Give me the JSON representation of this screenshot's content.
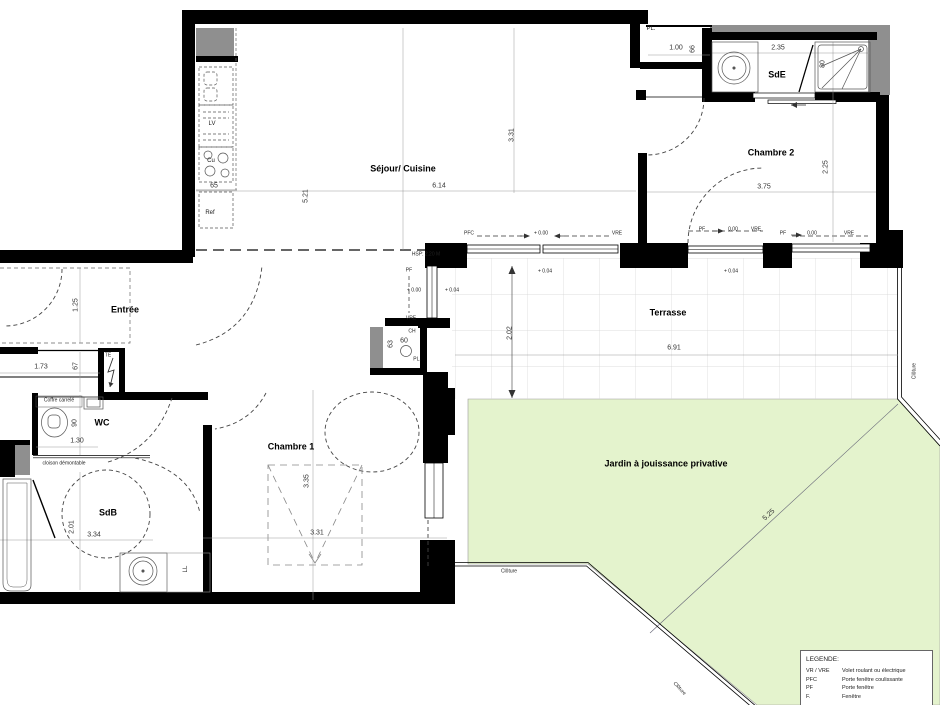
{
  "rooms": {
    "sejour": "Séjour/ Cuisine",
    "chambre2": "Chambre 2",
    "sde": "SdE",
    "entree": "Entrée",
    "wc": "WC",
    "sdb": "SdB",
    "chambre1": "Chambre 1",
    "terrasse": "Terrasse",
    "jardin": "Jardin à jouissance privative"
  },
  "dims": {
    "sejour_w": "6.14",
    "sejour_h": "5.21",
    "sejour_d": "3.31",
    "kitchen": "65",
    "ch2_w": "3.75",
    "ch2_h": "2.25",
    "sde_w": "2.35",
    "shower": "80",
    "placard_w": "1.00",
    "placard_d": "66",
    "entree": "1.25",
    "couloir_w": "1.73",
    "couloir_d": "67",
    "wc_d": "90",
    "wc_w": "1.30",
    "sdb_h": "2.01",
    "sdb_w": "3.34",
    "ch1_h": "3.35",
    "ch1_w": "3.31",
    "terrasse_w": "6.91",
    "terrasse_h": "2.02",
    "jardin_diag": "5.25",
    "ch_closet_h": "63",
    "ch_closet_w": "60"
  },
  "ann": {
    "pl": "PL.",
    "ch": "CH",
    "te": "TE",
    "lv": "LV",
    "cu": "Cu",
    "ref": "Ref",
    "ll": "LL",
    "coffre": "Coffre carrelé",
    "cloison": "cloison démontable",
    "hsp": "HSP: 2.20 M",
    "pfc": "PFC",
    "pf": "PF",
    "vre": "VRE",
    "lvl04": "+ 0.04",
    "lvl00": "+ 0.00",
    "zero": "0.00",
    "cloture": "Clôture"
  },
  "legend": {
    "title": "LEGENDE:",
    "rows": [
      [
        "VR / VRE",
        "Volet roulant ou électrique"
      ],
      [
        "PFC",
        "Porte fenêtre coulissante"
      ],
      [
        "PF",
        "Porte fenêtre"
      ],
      [
        "F.",
        "Fenêtre"
      ]
    ]
  },
  "colors": {
    "wall": "#000000",
    "masonry": "#8f8f8f",
    "garden": "#e4f3cd",
    "grid": "#d4d4d4"
  }
}
